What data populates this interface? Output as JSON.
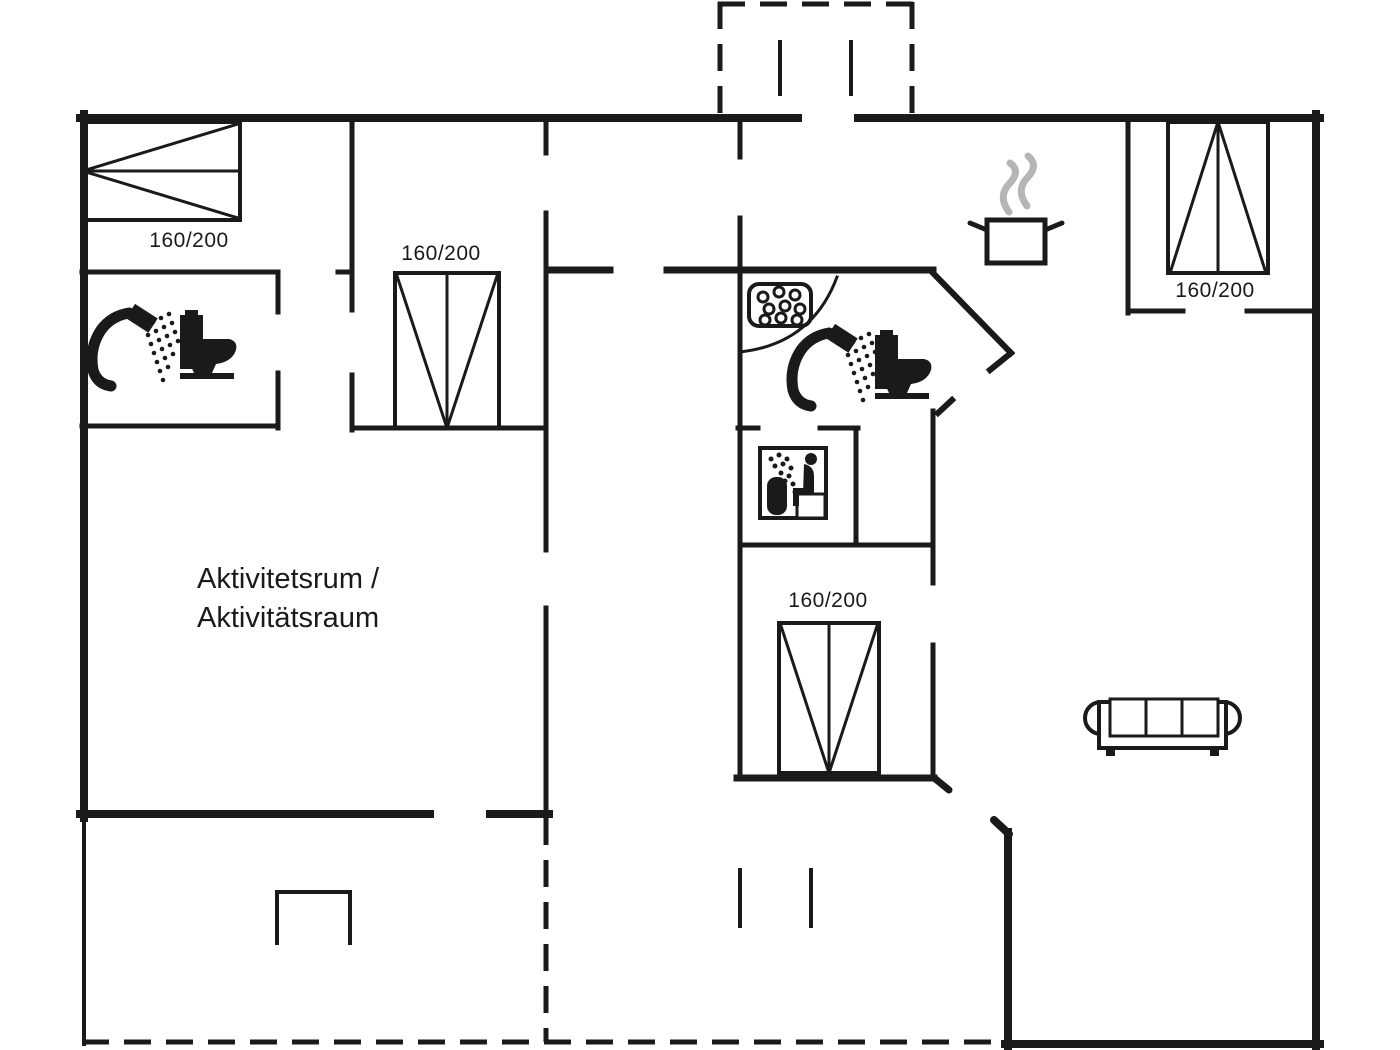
{
  "plan": {
    "background": "#ffffff",
    "line_color": "#1a1a1a",
    "steam_color": "#b5b5b5",
    "activity_room_label": {
      "line1": "Aktivitetsrum /",
      "line2": "Aktivitätsraum"
    },
    "beds": {
      "top_left": {
        "label": "160/200"
      },
      "middle": {
        "label": "160/200"
      },
      "top_right": {
        "label": "160/200"
      },
      "bottom_middle": {
        "label": "160/200"
      }
    },
    "icons": [
      "double-bed-icon",
      "shower-icon",
      "toilet-icon",
      "shower-tray-icon",
      "sauna-icon",
      "cooking-pot-icon",
      "steam-icon",
      "sofa-icon",
      "door-swing-arc",
      "terrace-niche"
    ]
  }
}
